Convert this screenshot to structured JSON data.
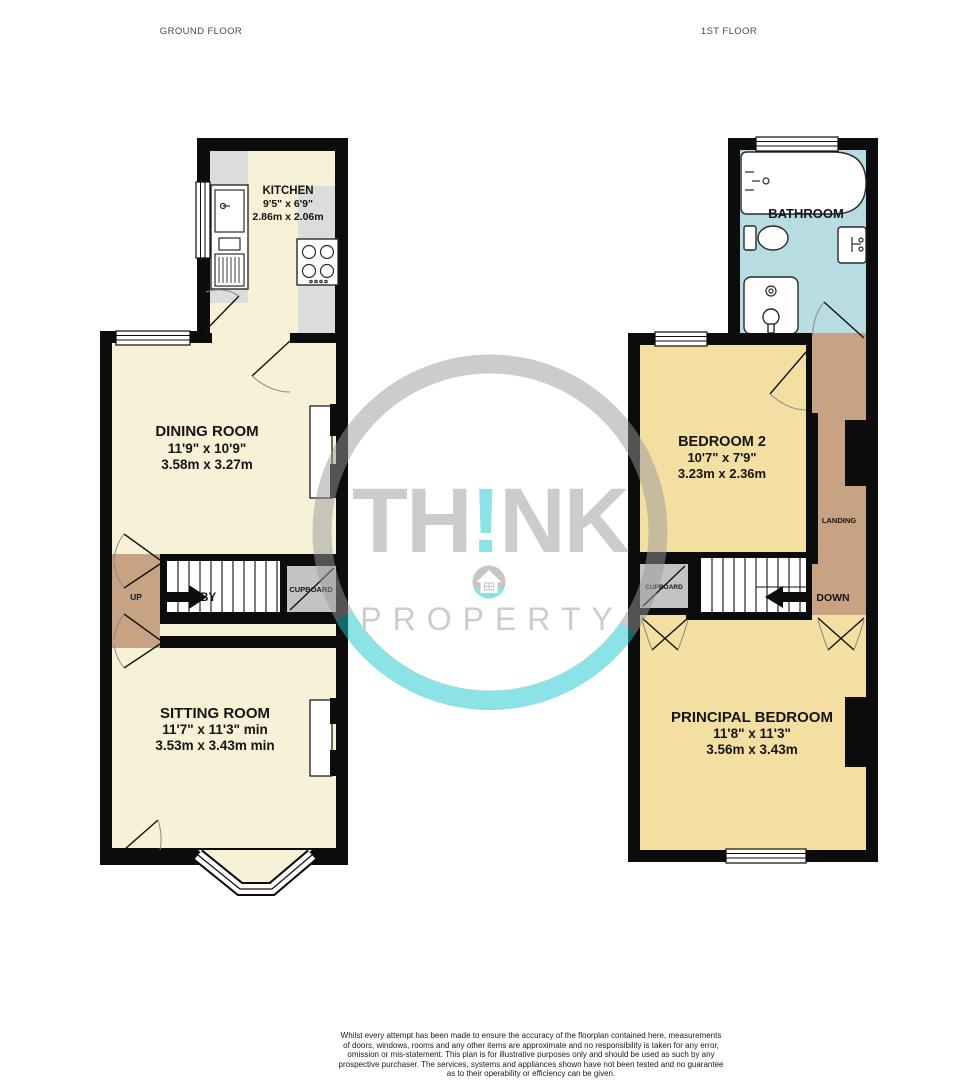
{
  "header": {
    "ground_floor_label": "GROUND FLOOR",
    "first_floor_label": "1ST FLOOR"
  },
  "ground_floor": {
    "kitchen": {
      "name": "KITCHEN",
      "imperial": "9'5\" x 6'9\"",
      "metric": "2.86m x 2.06m"
    },
    "dining_room": {
      "name": "DINING ROOM",
      "imperial": "11'9\" x 10'9\"",
      "metric": "3.58m x 3.27m"
    },
    "sitting_room": {
      "name": "SITTING ROOM",
      "imperial": "11'7\" x 11'3\" min",
      "metric": "3.53m x 3.43m min"
    },
    "lobby_label": "LOBBY",
    "up_label": "UP",
    "cupboard_label": "CUPBOARD"
  },
  "first_floor": {
    "bathroom": {
      "name": "BATHROOM"
    },
    "bedroom_2": {
      "name": "BEDROOM 2",
      "imperial": "10'7\" x 7'9\"",
      "metric": "3.23m x 2.36m"
    },
    "principal_bedroom": {
      "name": "PRINCIPAL BEDROOM",
      "imperial": "11'8\" x 11'3\"",
      "metric": "3.56m x 3.43m"
    },
    "landing_label": "LANDING",
    "down_label": "DOWN",
    "cupboard_label": "CUPBOARD"
  },
  "watermark": {
    "brand_part1": "TH",
    "brand_accent": "!",
    "brand_part2": "NK",
    "brand_word": "PROPERTY"
  },
  "footer": {
    "disclaimer_lines": [
      "Whilst every attempt has been made to ensure the accuracy of the floorplan contained here, measurements",
      "of doors, windows, rooms and any other items are approximate and no responsibility is taken for any error,",
      "omission or mis-statement. This plan is for illustrative purposes only and should be used as such by any",
      "prospective purchaser. The services, systems and appliances shown have not been tested and no guarantee",
      "as to their operability or efficiency can be given.",
      "Made with Metropix ©2025"
    ]
  },
  "colors": {
    "room_cream": "#f6f1d7",
    "room_yellow": "#f3dfa1",
    "bathroom_blue": "#b7dce2",
    "hall_tan": "#c7a283",
    "cupboard_gray": "#c3c3c3",
    "counter_gray": "#dcdcdc",
    "wall_black": "#0c0c0c",
    "watermark_gray": "#9a9a9a",
    "watermark_teal": "#19c9cd"
  }
}
